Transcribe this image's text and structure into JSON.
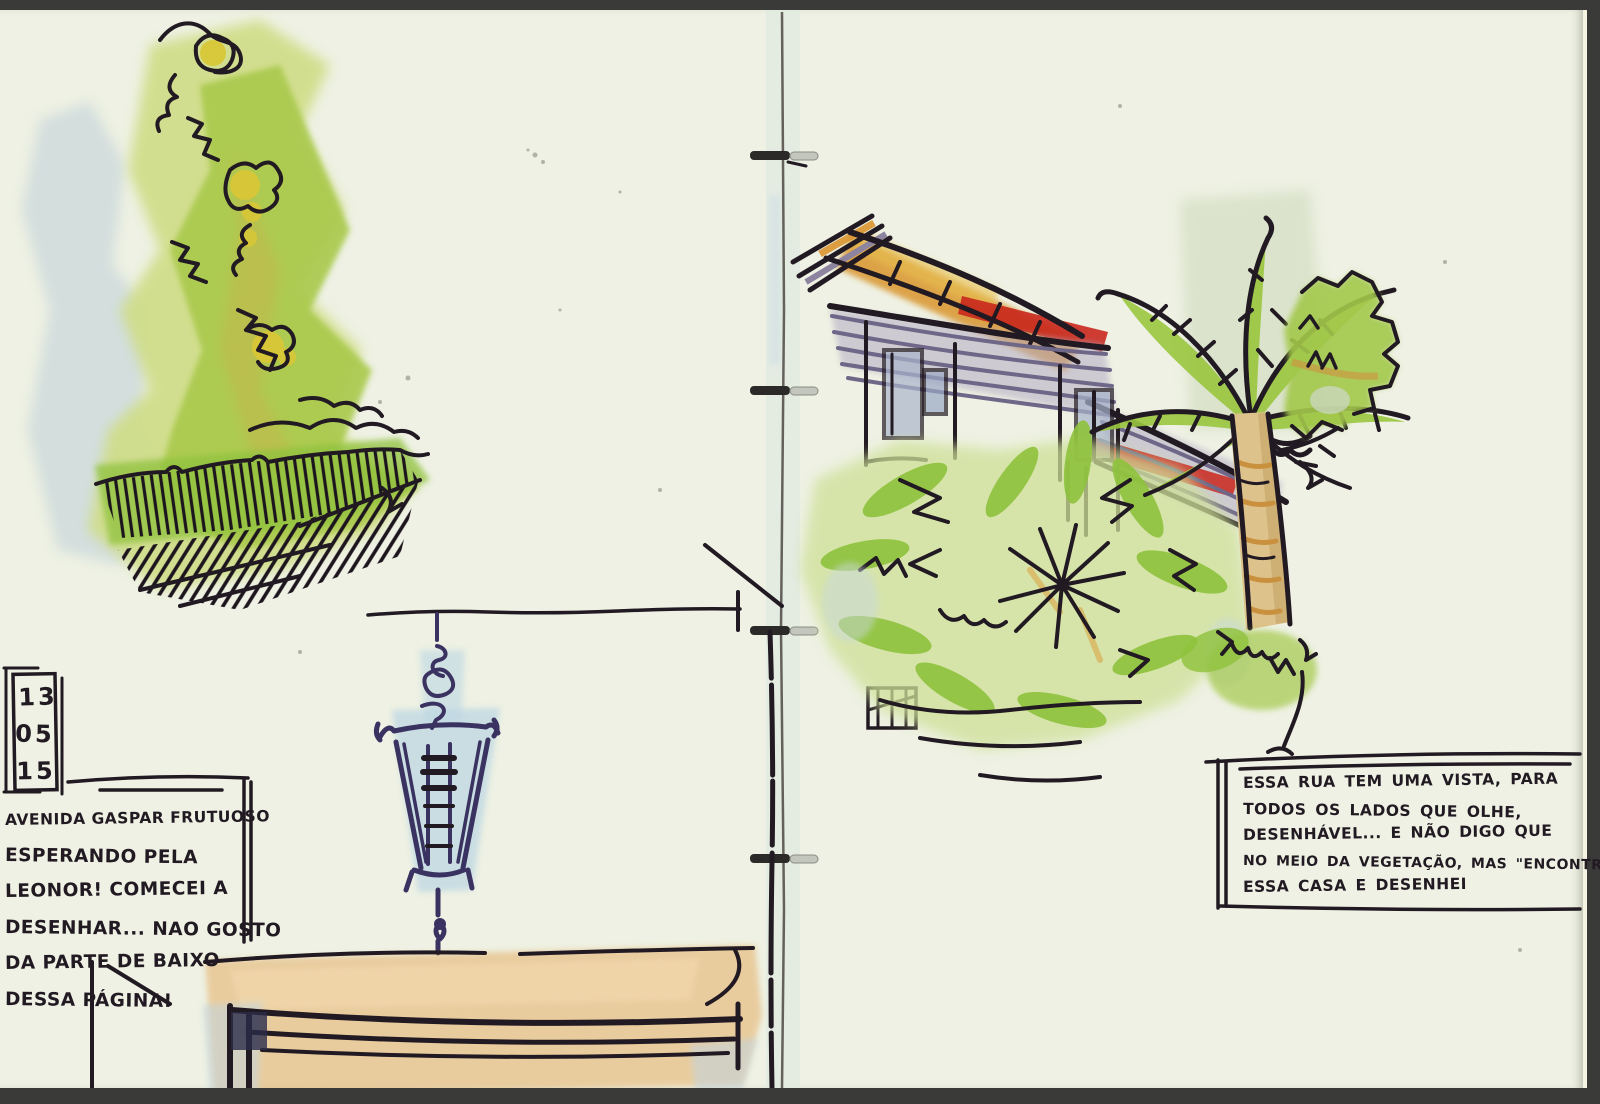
{
  "scan": {
    "date_stamp": {
      "lines": [
        "13",
        "05",
        "15"
      ]
    },
    "left_note": {
      "lines": [
        "AVENIDA GASPAR FRUTUOSO",
        "ESPERANDO PELA",
        "LEONOR! COMECEI A",
        "DESENHAR... NAO GOSTO",
        "DA PARTE DE BAIXO",
        "DESSA PÁGINA!"
      ]
    },
    "right_note": {
      "lines": [
        "ESSA RUA TEM UMA VISTA, PARA",
        "TODOS OS LADOS QUE OLHE,",
        "DESENHÁVEL... E NÃO DIGO QUE",
        "NO MEIO DA VEGETAÇÃO, MAS \"ENCONTREI\"",
        "ESSA CASA E DESENHEI"
      ]
    }
  },
  "colors": {
    "paper": "#eef1e3",
    "ink": "#221a22",
    "indigo": "#3a3260",
    "green": "#a9c94c",
    "leaf": "#8fc23c",
    "flower": "#d8c637",
    "bluewash": "#c5d4da",
    "wood": "#e3a85c",
    "rooforange": "#d9952f",
    "roofred": "#c9271d",
    "roofpurple": "#8d84a0",
    "trunk": "#dec28c",
    "border": "#3a3a38"
  }
}
